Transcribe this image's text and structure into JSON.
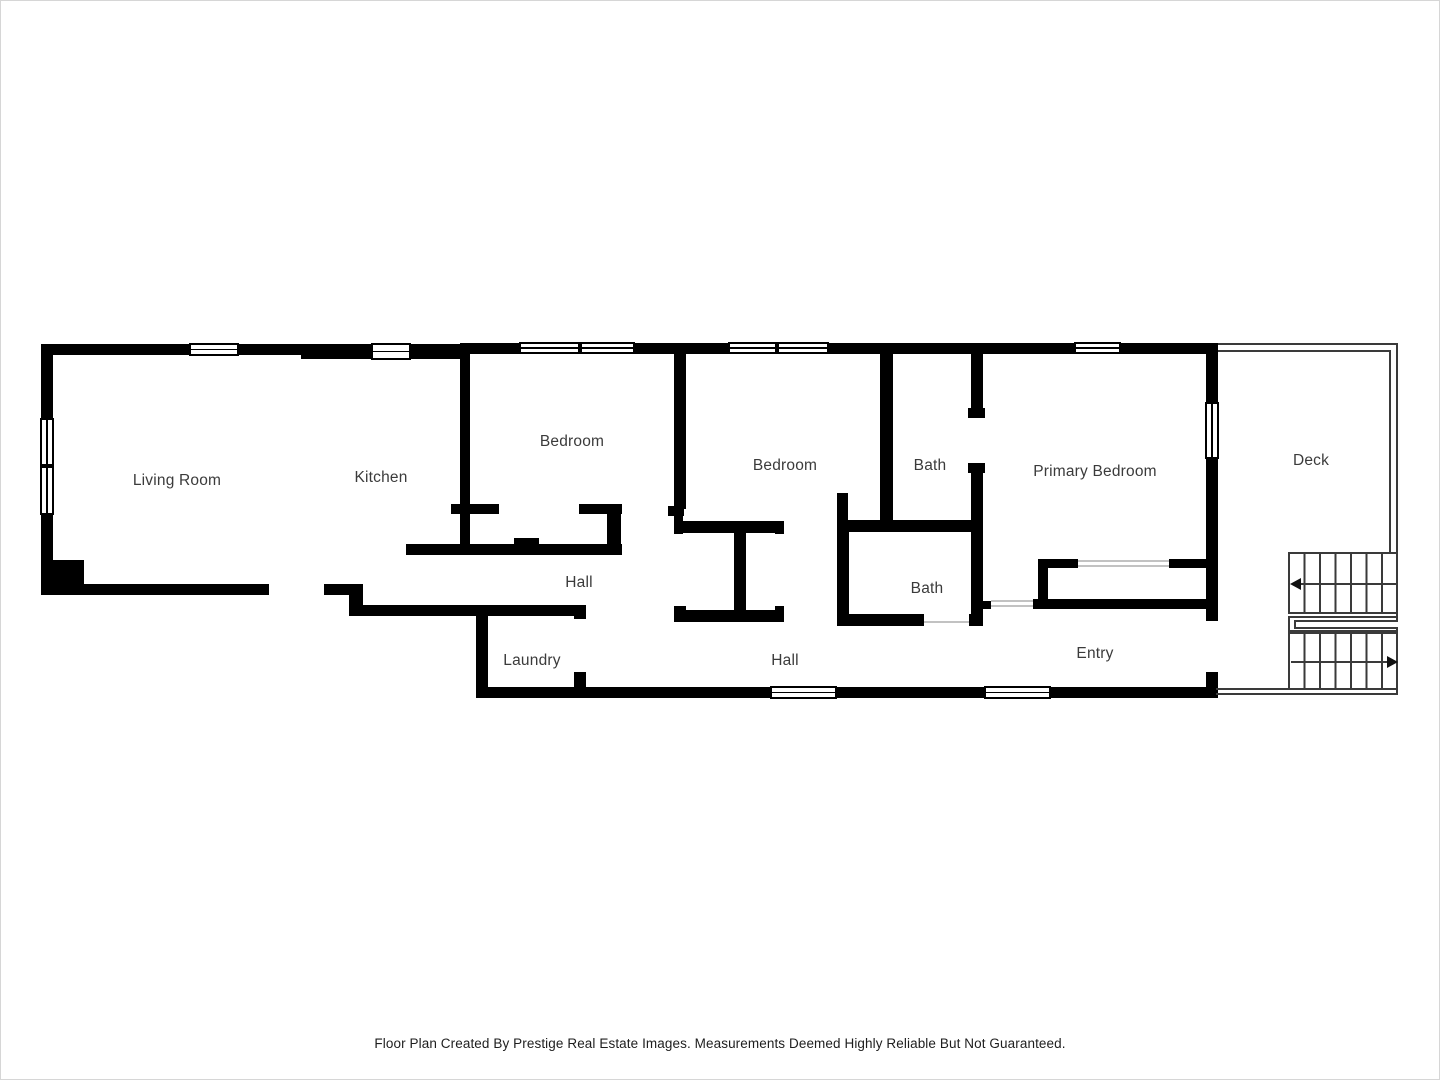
{
  "page": {
    "background_color": "#ffffff",
    "border_color": "#d6d6d6",
    "wall_color": "#000000",
    "thin_line_color": "#3a3a3a",
    "label_color": "#3b3b3b"
  },
  "floor_plan": {
    "rooms": [
      {
        "label": "Living Room"
      },
      {
        "label": "Kitchen"
      },
      {
        "label": "Bedroom"
      },
      {
        "label": "Bedroom"
      },
      {
        "label": "Bath"
      },
      {
        "label": "Primary Bedroom"
      },
      {
        "label": "Deck"
      },
      {
        "label": "Hall"
      },
      {
        "label": "Bath"
      },
      {
        "label": "Laundry"
      },
      {
        "label": "Hall"
      },
      {
        "label": "Entry"
      }
    ],
    "stairs": {
      "up_arrow_direction": "left",
      "down_arrow_direction": "right"
    }
  },
  "footer": {
    "text": "Floor Plan Created By Prestige Real Estate Images. Measurements Deemed Highly Reliable But Not Guaranteed."
  }
}
